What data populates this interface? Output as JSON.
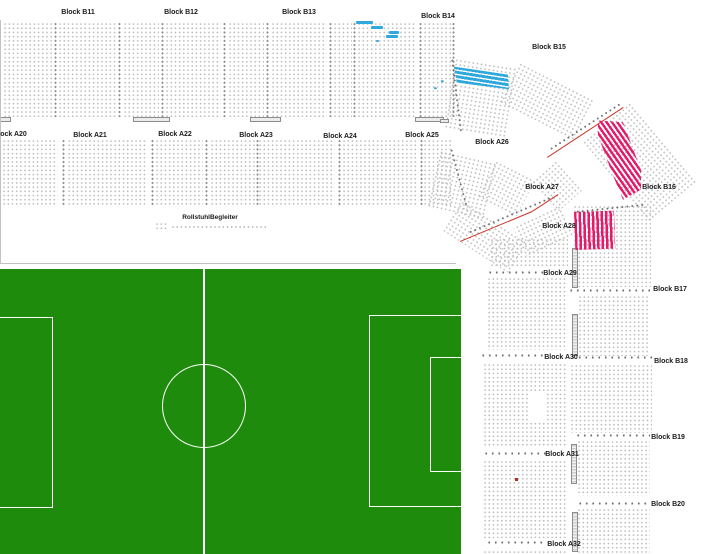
{
  "map_type": "stadium-seating-plan",
  "labels": {
    "b11": "Block B11",
    "b12": "Block B12",
    "b13": "Block B13",
    "b14": "Block B14",
    "b15": "Block B15",
    "b16": "Block B16",
    "b17": "Block B17",
    "b18": "Block B18",
    "b19": "Block B19",
    "b20": "Block B20",
    "a20": "Block A20",
    "a21": "Block A21",
    "a22": "Block A22",
    "a23": "Block A23",
    "a24": "Block A24",
    "a25": "Block A25",
    "a26": "Block A26",
    "a27": "Block A27",
    "a28": "Block A28",
    "a29": "Block A29",
    "a30": "Block A30",
    "a31": "Block A31",
    "a32": "Block A32",
    "rollstuhl": "RollstuhlBegleiter"
  },
  "colors": {
    "seat_available": "#bdbdbd",
    "seat_selected_cyan": "#2fa9dc",
    "seat_selected_pink": "#e51a6a",
    "pitch_green": "#1e8b0c",
    "aisle_red_line": "#cc3326"
  }
}
